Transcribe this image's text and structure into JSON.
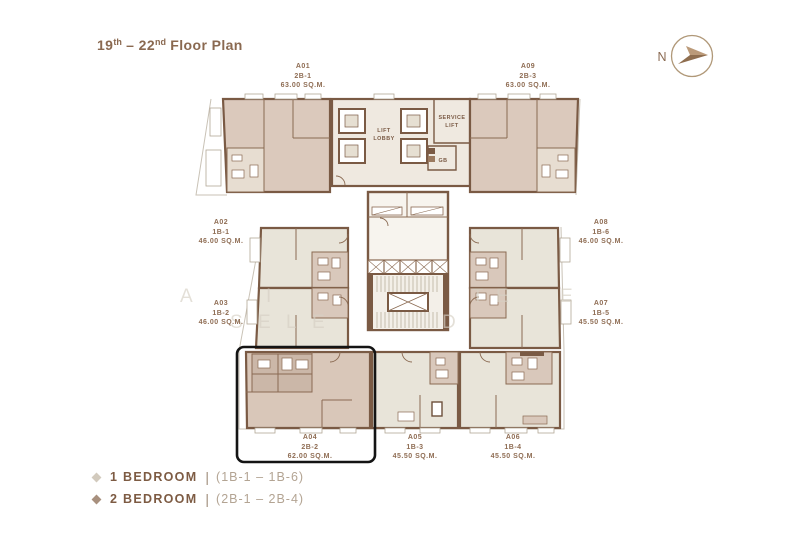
{
  "title": {
    "part1": "19",
    "sup1": "th",
    "part2": " – 22",
    "sup2": "nd",
    "part3": " Floor Plan"
  },
  "compass": {
    "label": "N"
  },
  "plan_labels": {
    "lift": "LIFT",
    "lobby": "LOBBY",
    "service": "SERVICE",
    "service_lift": "LIFT",
    "gb": "GB"
  },
  "units": [
    {
      "id": "A01",
      "code": "2B-1",
      "area": "63.00 SQ.M."
    },
    {
      "id": "A02",
      "code": "1B-1",
      "area": "46.00 SQ.M."
    },
    {
      "id": "A03",
      "code": "1B-2",
      "area": "46.00 SQ.M."
    },
    {
      "id": "A04",
      "code": "2B-2",
      "area": "62.00 SQ.M.",
      "highlighted": true
    },
    {
      "id": "A05",
      "code": "1B-3",
      "area": "45.50 SQ.M."
    },
    {
      "id": "A06",
      "code": "1B-4",
      "area": "45.50 SQ.M."
    },
    {
      "id": "A07",
      "code": "1B-5",
      "area": "45.50 SQ.M."
    },
    {
      "id": "A08",
      "code": "1B-6",
      "area": "46.00 SQ.M."
    },
    {
      "id": "A09",
      "code": "2B-3",
      "area": "63.00 SQ.M."
    }
  ],
  "legend": [
    {
      "label": "1 BEDROOM",
      "divider": "|",
      "range": "(1B-1 – 1B-6)",
      "swatch": "#d2cabd"
    },
    {
      "label": "2 BEDROOM",
      "divider": "|",
      "range": "(2B-1 – 2B-4)",
      "swatch": "#a8907e"
    }
  ],
  "watermark": {
    "row1": [
      "A",
      "I",
      "T",
      "E",
      "E"
    ],
    "row2": [
      "S",
      "E",
      "L",
      "E",
      "D"
    ]
  },
  "colors": {
    "accent_brown": "#8a6950",
    "wall": "#7a5a44",
    "unit_2b_fill": "#dbc9bc",
    "unit_1b_fill": "#e8e4d9",
    "bath_fill": "#d9c8bb",
    "lobby_fill": "#efe9e0",
    "highlight_outline": "#141414"
  }
}
